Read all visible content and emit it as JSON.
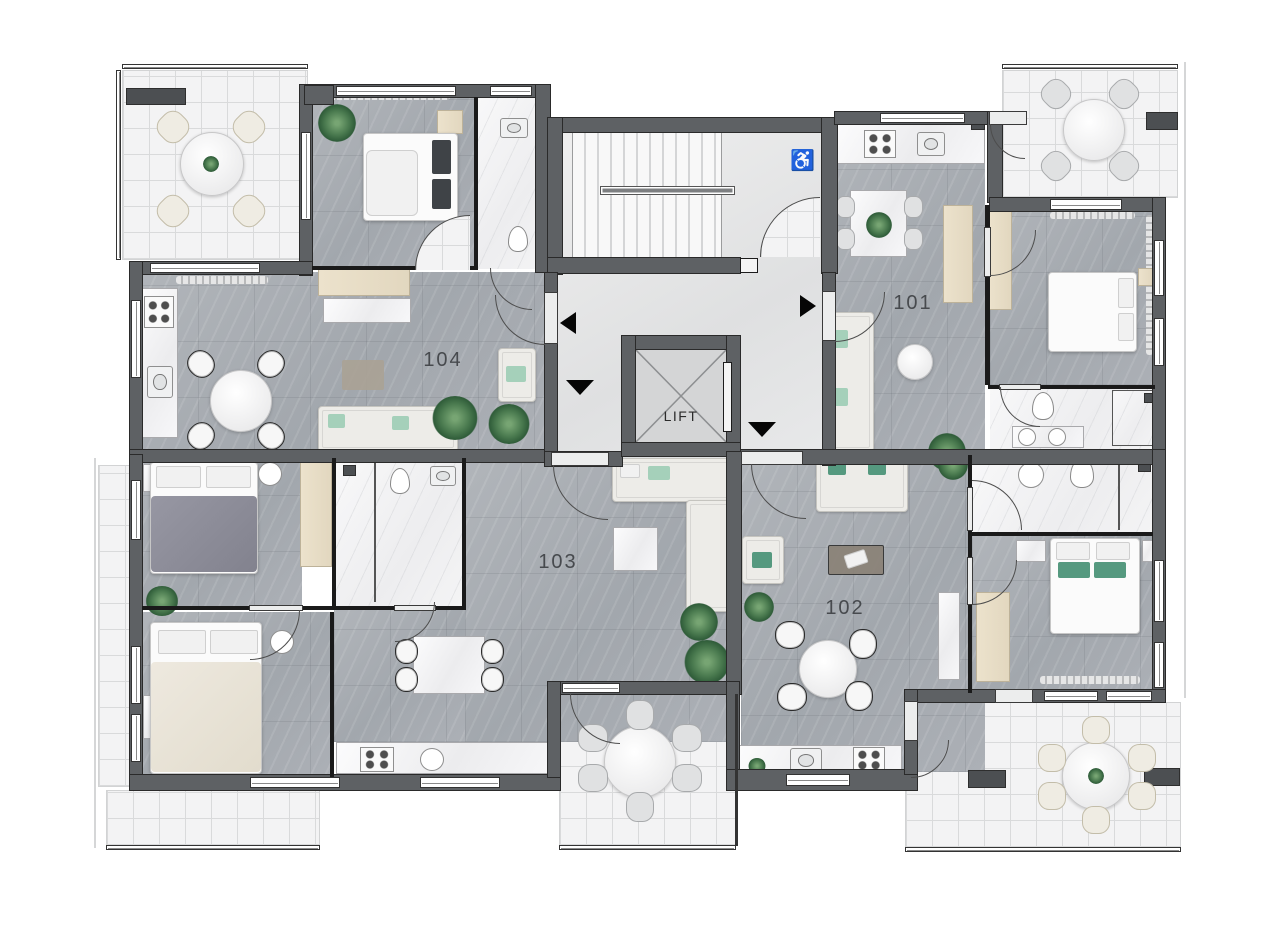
{
  "plan": {
    "type": "residential-floor-plan",
    "units": [
      {
        "id": "101",
        "label": "101"
      },
      {
        "id": "102",
        "label": "102"
      },
      {
        "id": "103",
        "label": "103"
      },
      {
        "id": "104",
        "label": "104"
      }
    ],
    "lift": {
      "label": "LIFT"
    },
    "stairs": {
      "accessible_icon": "♿"
    },
    "entrance_arrows": [
      {
        "unit": "104",
        "direction": "left"
      },
      {
        "unit": "101",
        "direction": "right"
      },
      {
        "unit": "103",
        "direction": "down"
      },
      {
        "unit": "102",
        "direction": "down"
      }
    ],
    "colors": {
      "wall": "#5e6164",
      "partition": "#1a1a1a",
      "apartment_floor": "#a7acb2",
      "corridor_floor": "#e4e5e6",
      "bathroom_floor": "#f4f4f5",
      "balcony_tile": "#f1f1f2",
      "wood": "#e7ddc6",
      "plant_green": "#4a7a4f",
      "teal_pillow": "#55997f",
      "mint_pillow": "#a5d0ba"
    }
  }
}
